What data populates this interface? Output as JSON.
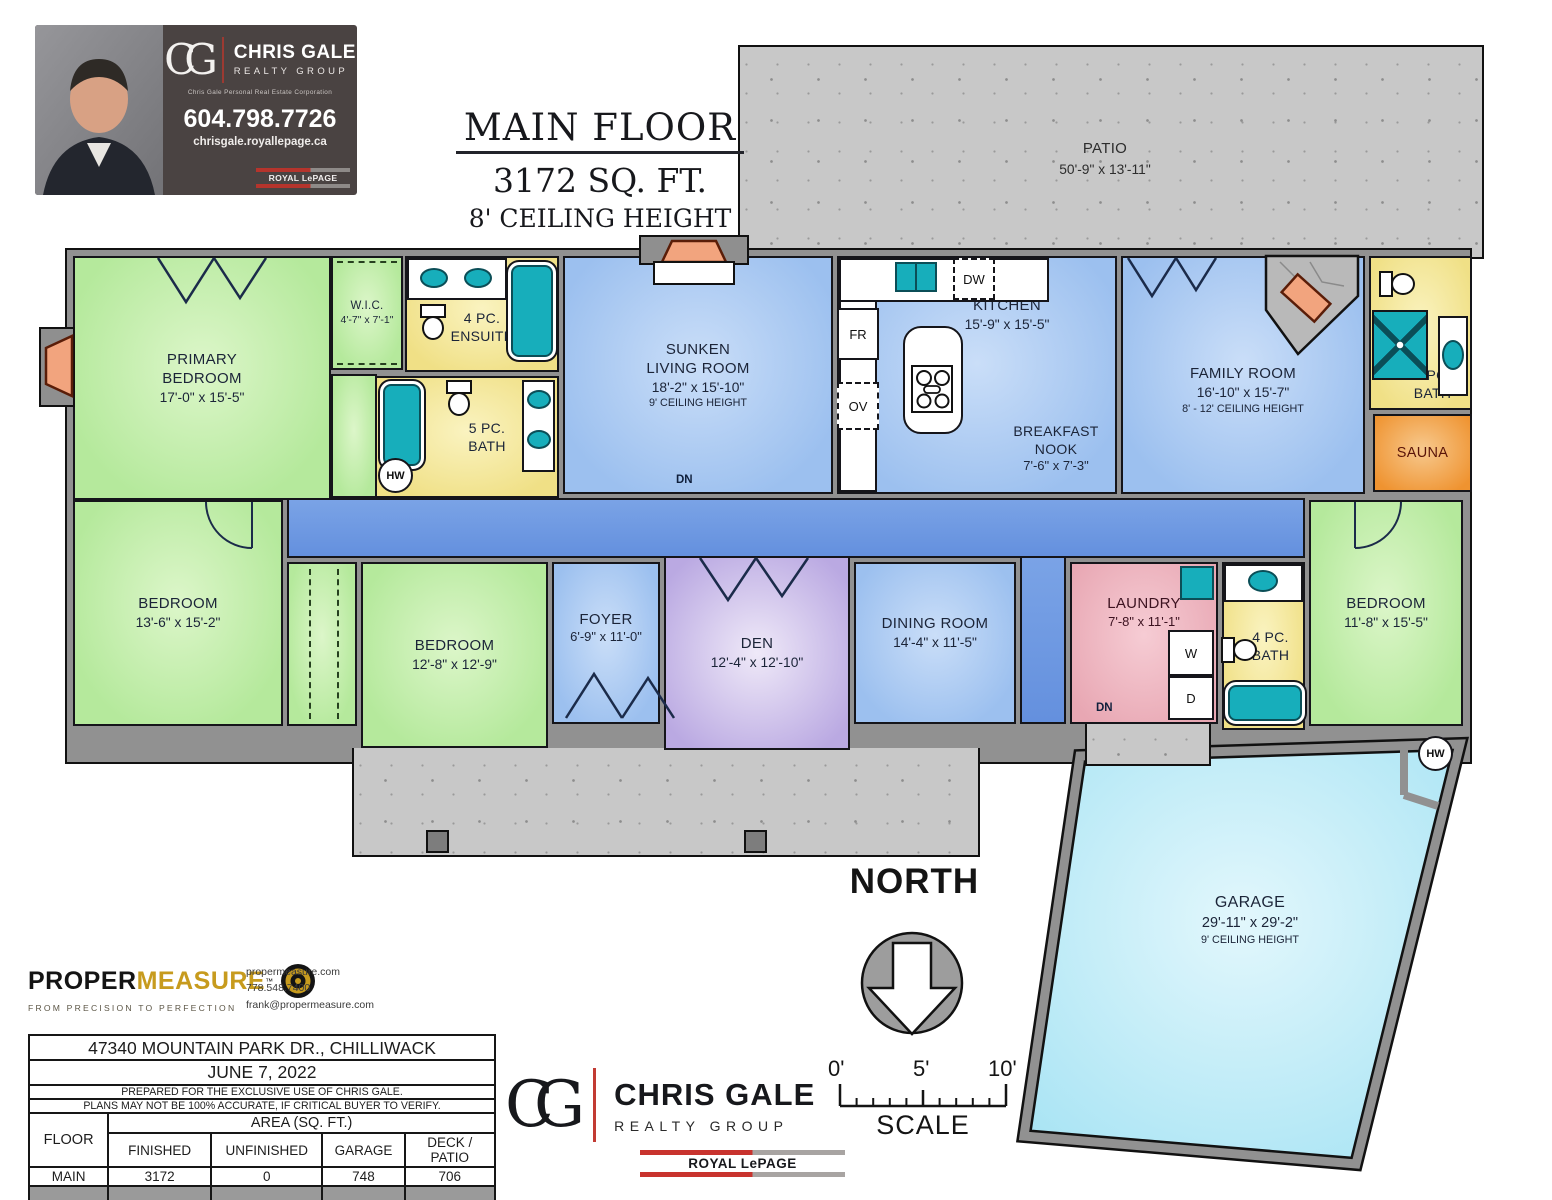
{
  "palette": {
    "room_green": "#b5e99c",
    "room_blue": "#9cc0ef",
    "hall_blue": "#6490de",
    "bath_yellow": "#f0e086",
    "den_purple": "#baa9e2",
    "laundry_pink": "#e8a7b3",
    "sauna_orange": "#ef9330",
    "garage_cyan": "#a9e4f4",
    "fixture_teal": "#17aebb",
    "patio_gray": "#c8c8c8",
    "wall_gray": "#919191",
    "brand_red": "#c8332e",
    "brand_gold": "#c79b1e"
  },
  "business_card": {
    "monogram": "CG",
    "name": "CHRIS GALE",
    "group": "REALTY GROUP",
    "subtitle": "Chris Gale Personal Real Estate Corporation",
    "phone": "604.798.7726",
    "website": "chrisgale.royallepage.ca",
    "brand": "ROYAL LePAGE"
  },
  "title_block": {
    "line1": "MAIN FLOOR",
    "line2": "3172 SQ. FT.",
    "line3": "8' CEILING HEIGHT"
  },
  "north_label": "NORTH",
  "scale_bar": {
    "t0": "0'",
    "t5": "5'",
    "t10": "10'",
    "label": "SCALE"
  },
  "fixtures": {
    "fridge": "FR",
    "oven": "OV",
    "dishwasher": "DW",
    "washer": "W",
    "dryer": "D",
    "hot_water": "HW",
    "down": "DN"
  },
  "rooms": {
    "patio": {
      "name": "PATIO",
      "dims": "50'-9\" x 13'-11\""
    },
    "primary": {
      "name": "PRIMARY BEDROOM",
      "dims": "17'-0\" x 15'-5\""
    },
    "wic": {
      "name": "W.I.C.",
      "dims": "4'-7\" x 7'-1\""
    },
    "ensuite": {
      "name": "4 PC. ENSUITE"
    },
    "bath5": {
      "name": "5 PC. BATH"
    },
    "living": {
      "name": "SUNKEN LIVING ROOM",
      "dims": "18'-2\" x 15'-10\"",
      "note": "9' CEILING HEIGHT"
    },
    "kitchen": {
      "name": "KITCHEN",
      "dims": "15'-9\" x 15'-5\""
    },
    "nook": {
      "name": "BREAKFAST NOOK",
      "dims": "7'-6\" x 7'-3\""
    },
    "family": {
      "name": "FAMILY ROOM",
      "dims": "16'-10\" x 15'-7\"",
      "note": "8' - 12' CEILING HEIGHT"
    },
    "bath3": {
      "name": "3 PC. BATH"
    },
    "sauna": {
      "name": "SAUNA"
    },
    "bed1": {
      "name": "BEDROOM",
      "dims": "13'-6\" x 15'-2\""
    },
    "bed2": {
      "name": "BEDROOM",
      "dims": "12'-8\" x 12'-9\""
    },
    "foyer": {
      "name": "FOYER",
      "dims": "6'-9\" x 11'-0\""
    },
    "den": {
      "name": "DEN",
      "dims": "12'-4\" x 12'-10\""
    },
    "dining": {
      "name": "DINING ROOM",
      "dims": "14'-4\" x 11'-5\""
    },
    "laundry": {
      "name": "LAUNDRY",
      "dims": "7'-8\" x 11'-1\""
    },
    "bath4": {
      "name": "4 PC. BATH"
    },
    "bed3": {
      "name": "BEDROOM",
      "dims": "11'-8\" x 15'-5\""
    },
    "garage": {
      "name": "GARAGE",
      "dims": "29'-11\" x 29'-2\"",
      "note": "9' CEILING HEIGHT"
    }
  },
  "propermeasure": {
    "brand_black": "PROPER",
    "brand_gold": "MEASURE",
    "tm": "™",
    "tagline": "FROM PRECISION TO PERFECTION",
    "website": "propermeasure.com",
    "phone": "778.548.7400",
    "email": "frank@propermeasure.com"
  },
  "area_table": {
    "address": "47340 MOUNTAIN PARK DR., CHILLIWACK",
    "date": "JUNE 7, 2022",
    "note1": "PREPARED FOR THE EXCLUSIVE USE OF CHRIS GALE.",
    "note2": "PLANS MAY NOT BE 100% ACCURATE, IF CRITICAL BUYER TO VERIFY.",
    "col_floor": "FLOOR",
    "col_area": "AREA (SQ. FT.)",
    "col_finished": "FINISHED",
    "col_unfinished": "UNFINISHED",
    "col_garage": "GARAGE",
    "col_deck": "DECK / PATIO",
    "rows": [
      {
        "floor": "MAIN",
        "finished": "3172",
        "unfinished": "0",
        "garage": "748",
        "deck": "706"
      },
      {
        "floor": "TOTAL",
        "finished": "3172",
        "unfinished": "0",
        "garage": "748",
        "deck": "706"
      }
    ]
  },
  "footer_logo": {
    "monogram": "CG",
    "name": "CHRIS GALE",
    "group": "REALTY GROUP",
    "brand": "ROYAL LePAGE"
  }
}
